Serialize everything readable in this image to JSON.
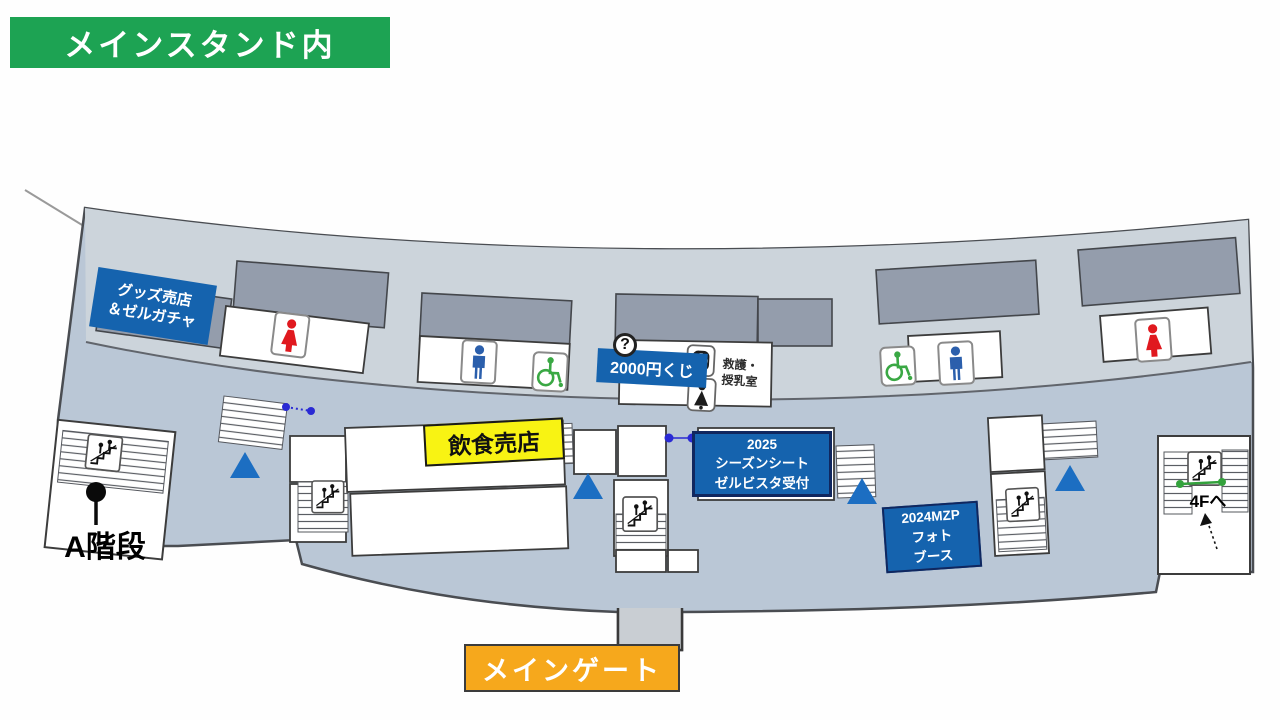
{
  "banners": {
    "area_title": "メインスタンド内",
    "main_gate": "メインゲート"
  },
  "labels": {
    "goods_shop": "グッズ売店\n＆ゼルガチャ",
    "lottery_2000": "2000円くじ",
    "food_stall": "飲食売店",
    "season_seat": "2025\nシーズンシート\nゼルビスタ受付",
    "photo_booth": "2024MZP\nフォト\nブース",
    "first_aid_nursing": "救護・\n授乳室",
    "stairs_a": "A階段",
    "to_4f": "4Fへ",
    "info": "?"
  },
  "icons": [
    "info-icon",
    "first-aid-icon",
    "nursing-room-icon",
    "female-restroom-icon",
    "male-restroom-icon",
    "wheelchair-icon",
    "stairs-icon",
    "direction-triangle"
  ],
  "colors": {
    "green": "#1da353",
    "orange": "#f6a81c",
    "blue": "#1563ae",
    "yellow": "#f8f313",
    "walkway": "#bac7d6",
    "band": "#ccd4db",
    "block": "#949dac",
    "triangle": "#1c6ec2",
    "leader": "#2a2ad4",
    "green_line": "#33a23c",
    "restroom_female": "#e0191f",
    "restroom_male": "#2b5fac",
    "wheelchair_green": "#3aa844"
  }
}
